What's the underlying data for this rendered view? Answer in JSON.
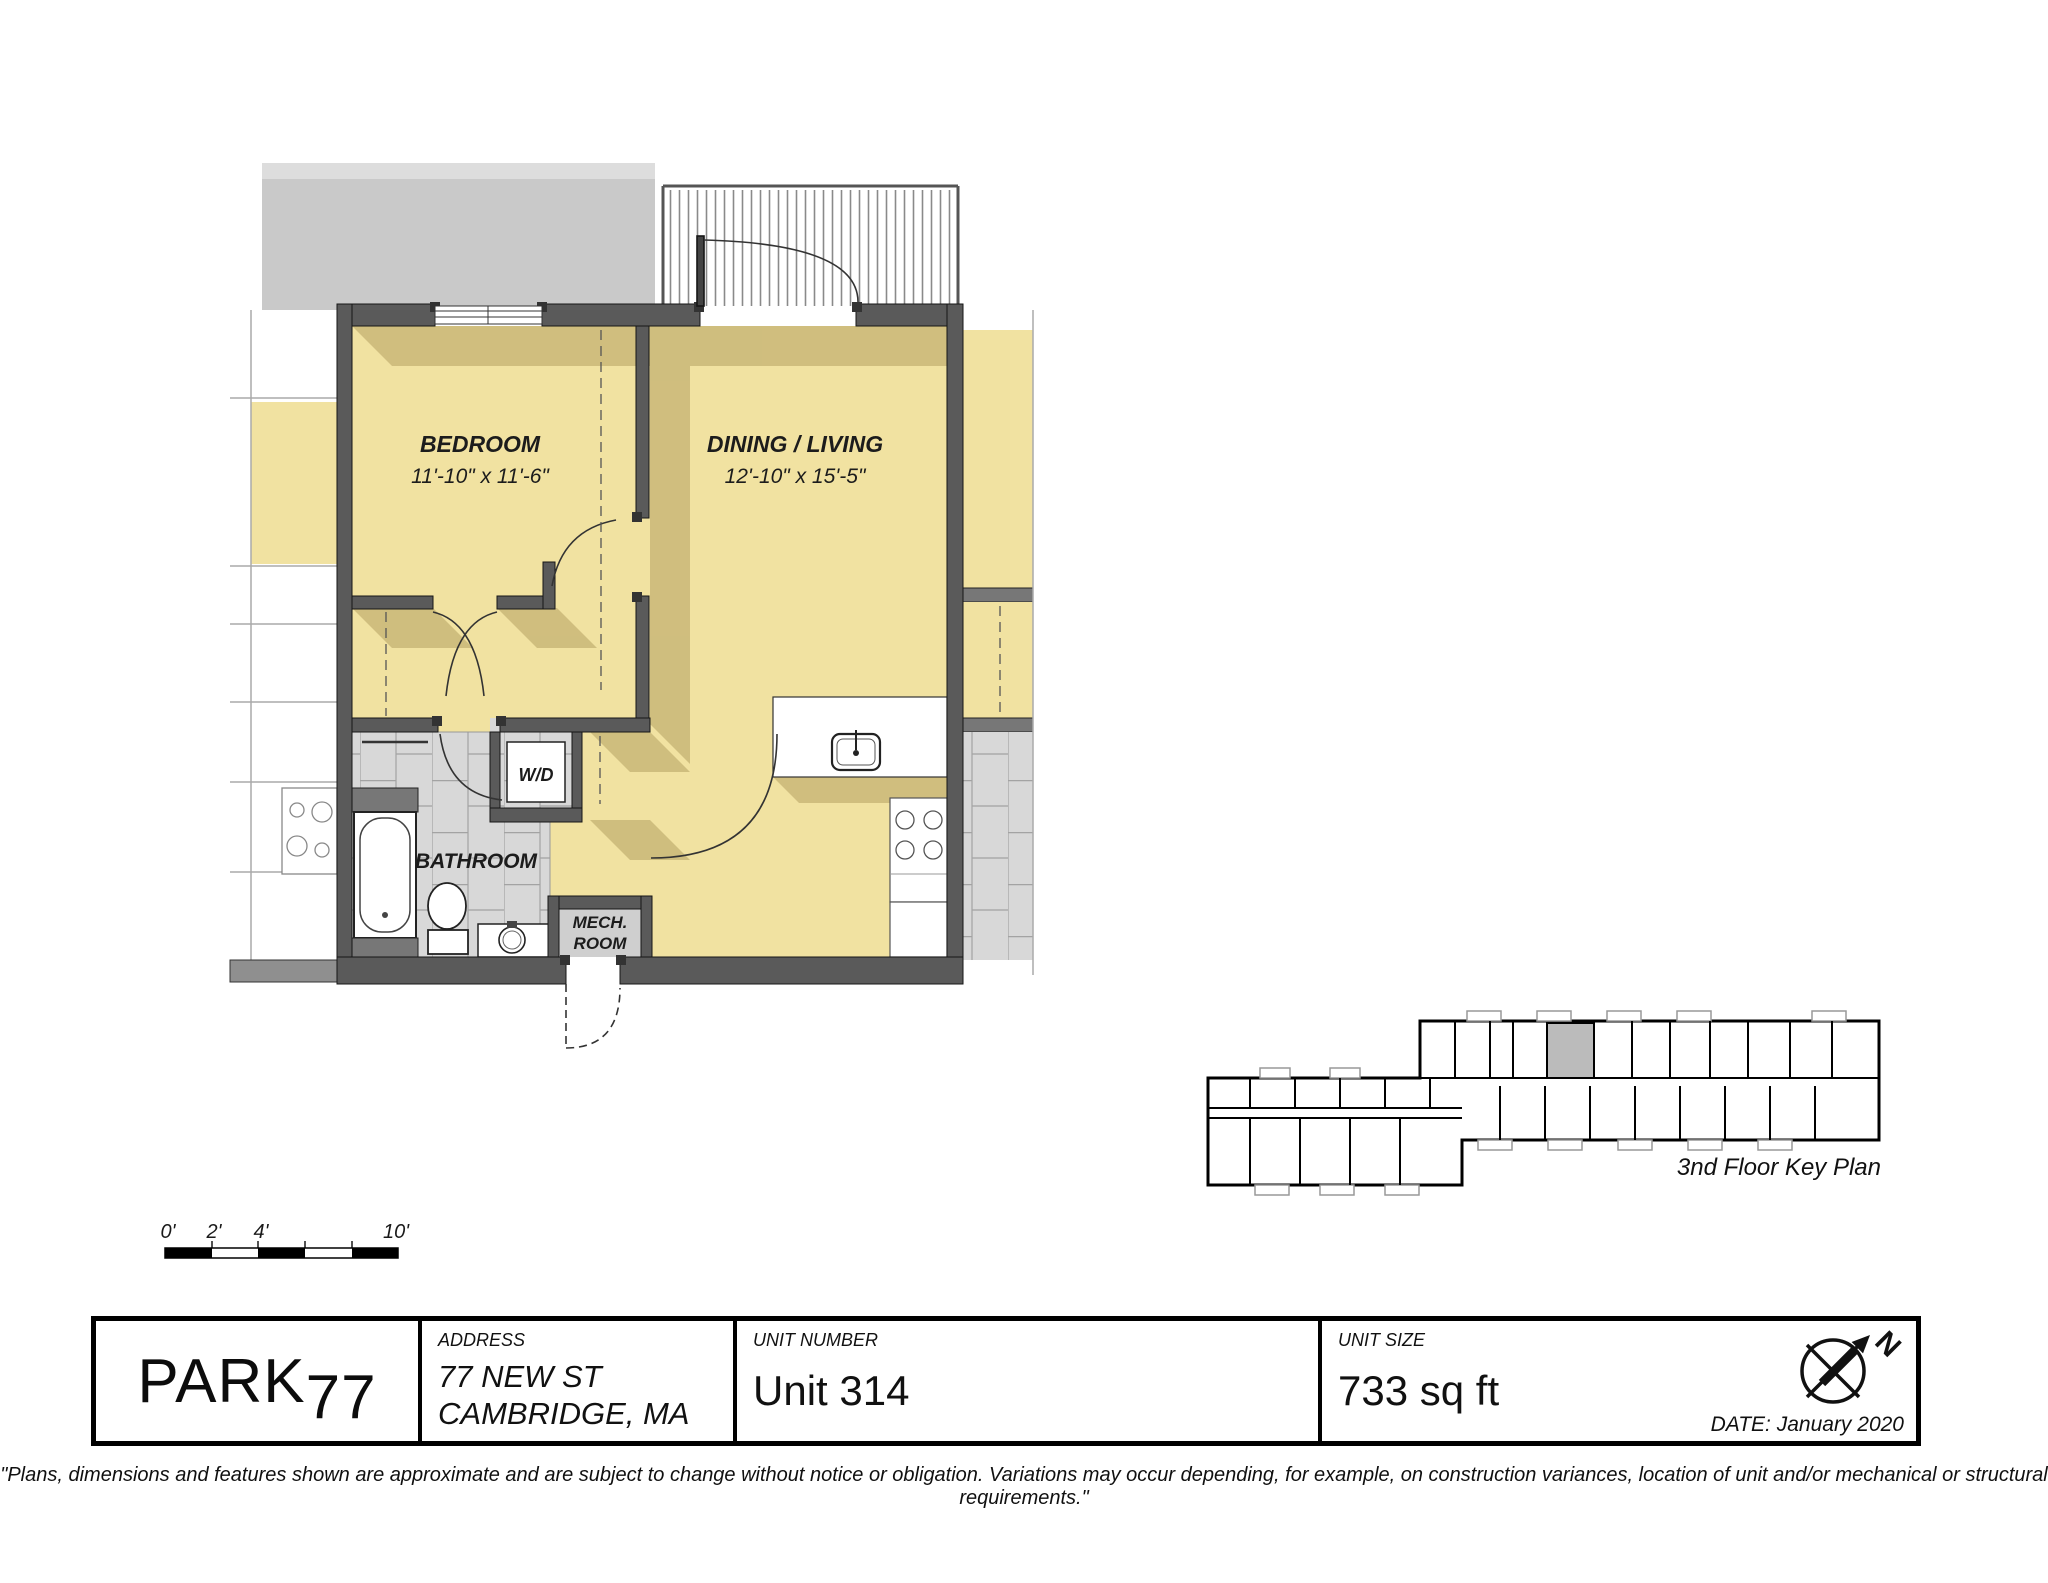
{
  "colors": {
    "room_fill": "#f1e2a1",
    "wall": "#5a5a5a",
    "shadow": "#a89355",
    "tile": "#d8d8d8",
    "neighbor_gray": "#c9c9c9"
  },
  "plan": {
    "bedroom_name": "BEDROOM",
    "bedroom_dims": "11'-10\" x 11'-6\"",
    "living_name": "DINING / LIVING",
    "living_dims": "12'-10\" x 15'-5\"",
    "bathroom_name": "BATHROOM",
    "wd_name": "W/D",
    "mech_line1": "MECH.",
    "mech_line2": "ROOM"
  },
  "key_plan": {
    "caption": "3nd Floor Key Plan"
  },
  "scale_bar": {
    "l0": "0'",
    "l1": "2'",
    "l2": "4'",
    "l3": "10'"
  },
  "title_block": {
    "logo_park": "PARK",
    "logo_77": "77",
    "address_label": "ADDRESS",
    "address_line1": "77 NEW ST",
    "address_line2": "CAMBRIDGE, MA",
    "unit_label": "UNIT NUMBER",
    "unit_value": "Unit 314",
    "size_label": "UNIT SIZE",
    "size_value": "733 sq ft",
    "north": "N",
    "date": "DATE: January 2020"
  },
  "disclaimer": "\"Plans, dimensions and features shown are approximate and are subject to change without notice or obligation. Variations may occur depending, for example, on construction variances, location of unit and/or mechanical or structural requirements.\""
}
